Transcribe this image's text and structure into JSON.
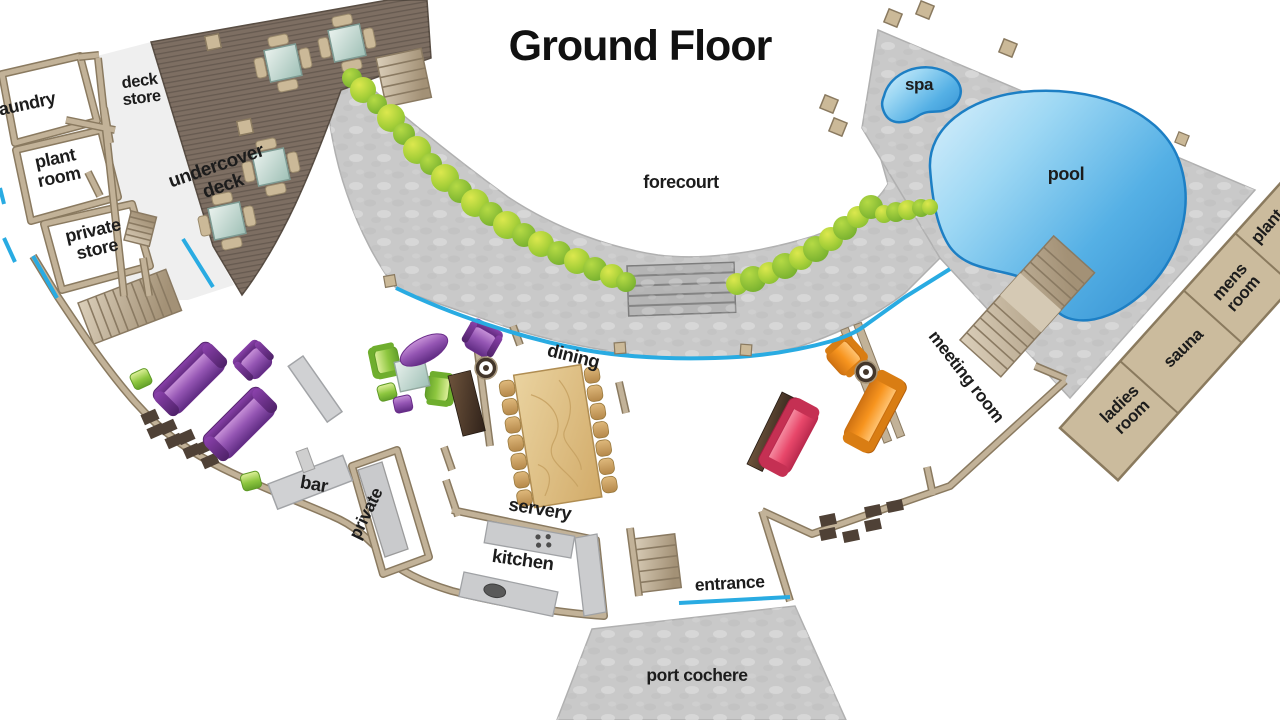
{
  "title": "Ground Floor",
  "rooms": {
    "laundry": "laundry",
    "deck_store": [
      "deck",
      "store"
    ],
    "plant_room": [
      "plant",
      "room"
    ],
    "private_store": [
      "private",
      "store"
    ],
    "undercover_deck": [
      "undercover",
      "deck"
    ],
    "forecourt": "forecourt",
    "spa": "spa",
    "pool": "pool",
    "plant": "plant",
    "mens_room": [
      "mens",
      "room"
    ],
    "sauna": "sauna",
    "ladies_room": [
      "ladies",
      "room"
    ],
    "meeting_room": "meeting room",
    "dining": "dining",
    "bar": "bar",
    "private": "private",
    "servery": "servery",
    "kitchen": "kitchen",
    "entrance": "entrance",
    "port_cochere": "port cochere"
  },
  "colors": {
    "glass": "#29abe2",
    "walls": "#c2b298",
    "wall_outline": "#8a7a60",
    "stone": "#c9c9c9",
    "deck_wood": "#7d6e62",
    "pool_water": "#55b0e5",
    "pool_edge": "#1d7fc4",
    "shrub_green": "#8cc63f",
    "room_tan": "#cbbb9d",
    "sofa_purple": "#8e44ad",
    "sofa_orange": "#f7941e",
    "sofa_red": "#e8476a",
    "chair_green": "#8dc63f",
    "counter_gray": "#c9cacc",
    "feature_dark": "#4a3a2c",
    "timber": "#d9b97f",
    "label_ink": "#1c1c1c"
  }
}
